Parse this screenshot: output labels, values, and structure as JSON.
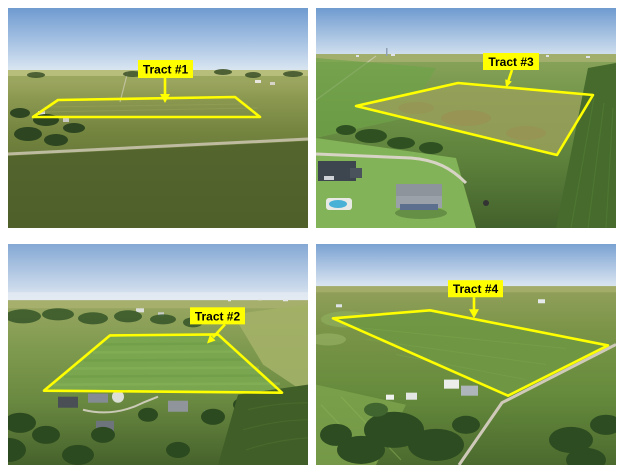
{
  "collage": {
    "type": "2x2 grid of aerial farmland photos",
    "background_color": "#ffffff"
  },
  "colors": {
    "tract_outline": "#ffff00",
    "label_background": "#ffff00",
    "label_text": "#000000",
    "sky_top": "#6f9bd0",
    "sky_horizon": "#dde8f2",
    "field_green": "#6f8a3f",
    "tree_green": "#2e4c21",
    "road_tan": "#d2cdbd",
    "pool_blue": "#4db3dc"
  },
  "tracts": [
    {
      "label": "Tract #1",
      "grid_position": "top-left",
      "outline_points": "25,109 50,92 227,89 252,109"
    },
    {
      "label": "Tract #3",
      "grid_position": "top-right",
      "outline_points": "40,98 142,75 277,87 241,147"
    },
    {
      "label": "Tract #2",
      "grid_position": "bottom-left",
      "outline_points": "102,91 210,90 274,148 36,146"
    },
    {
      "label": "Tract #4",
      "grid_position": "bottom-right",
      "outline_points": "17,74 114,66 292,101 192,151"
    }
  ]
}
